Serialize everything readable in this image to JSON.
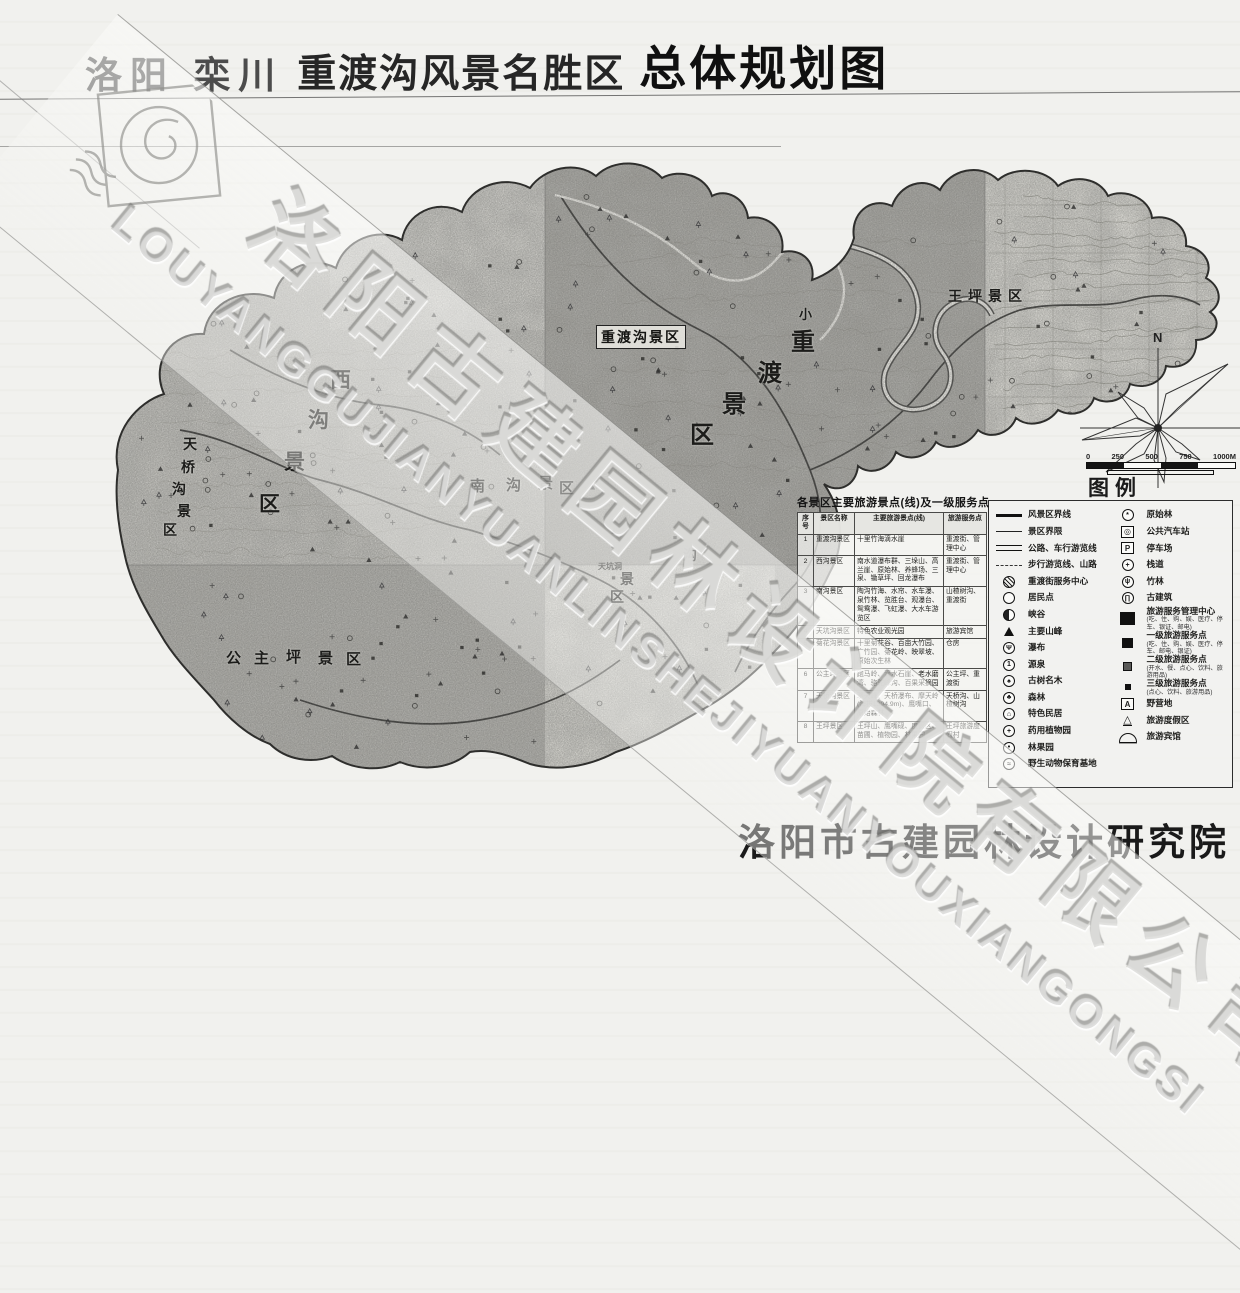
{
  "title": {
    "prefix": "洛阳 栾川",
    "name": "重渡沟风景名胜区",
    "suffix": "总体规划图"
  },
  "watermark": {
    "chinese": "洛阳古建园林设计院有限公司",
    "latin": "LOUYANGGUJIANYUANLINSHEJIYUANYOUXIANGONGSI"
  },
  "footer": {
    "publisher": "洛阳市古建园林设计研究院"
  },
  "compass": {
    "north_label": "N"
  },
  "scale_bar": {
    "ticks": [
      "0",
      "250",
      "500",
      "750",
      "1000M"
    ]
  },
  "legend": {
    "title": "图例",
    "left": [
      {
        "icon": "line-thick",
        "label": "风景区界线"
      },
      {
        "icon": "line-thin",
        "label": "景区界限"
      },
      {
        "icon": "line-double",
        "label": "公路、车行游览线"
      },
      {
        "icon": "line-dashed",
        "label": "步行游览线、山路"
      },
      {
        "icon": "circle-hatched",
        "label": "重渡街服务中心"
      },
      {
        "icon": "circle-open",
        "label": "居民点"
      },
      {
        "icon": "circle-half",
        "label": "峡谷"
      },
      {
        "icon": "triangle",
        "label": "主要山峰"
      },
      {
        "icon": "circle-waterfall",
        "label": "瀑布"
      },
      {
        "icon": "circle-one",
        "label": "源泉"
      },
      {
        "icon": "circle-tree",
        "label": "古树名木"
      },
      {
        "icon": "circle-forest",
        "label": "森林"
      },
      {
        "icon": "circle-house",
        "label": "特色民居"
      },
      {
        "icon": "circle-herb",
        "label": "药用植物园"
      },
      {
        "icon": "circle-fruit",
        "label": "林果园"
      },
      {
        "icon": "circle-animal",
        "label": "野生动物保育基地"
      }
    ],
    "right": [
      {
        "icon": "circle-pforest",
        "label": "原始林"
      },
      {
        "icon": "square-bus",
        "label": "公共汽车站"
      },
      {
        "icon": "square-p",
        "label": "停车场"
      },
      {
        "icon": "circle-cross",
        "label": "栈道"
      },
      {
        "icon": "circle-bamboo",
        "label": "竹林"
      },
      {
        "icon": "circle-temple",
        "label": "古建筑"
      },
      {
        "icon": "sq-xl",
        "label": "旅游服务管理中心",
        "note": "(吃、住、购、娱、医疗、停车、银证、邮电)"
      },
      {
        "icon": "sq-l",
        "label": "一级旅游服务点",
        "note": "(吃、住、购、娱、医疗、停车、邮电、银证)"
      },
      {
        "icon": "sq-m",
        "label": "二级旅游服务点",
        "note": "(开水、餐、点心、饮料、旅游用品)"
      },
      {
        "icon": "sq-s",
        "label": "三级旅游服务点",
        "note": "(点心、饮料、旅游用品)"
      },
      {
        "icon": "square-a",
        "label": "野营地"
      },
      {
        "icon": "tent",
        "label": "旅游度假区"
      },
      {
        "icon": "dome",
        "label": "旅游宾馆"
      }
    ]
  },
  "table": {
    "title": "各景区主要旅游景点(线)及一级服务点",
    "headers": [
      "序号",
      "景区名称",
      "主要旅游景点(线)",
      "旅游服务点"
    ],
    "rows": [
      [
        "1",
        "重渡沟景区",
        "十里竹海滴水崖",
        "重渡街、管理中心"
      ],
      [
        "2",
        "西沟景区",
        "南水道瀑布群、三垛山、高兰崖、原始林、养蜂场、三泉、锄草坪、回龙瀑布",
        "重渡街、管理中心"
      ],
      [
        "3",
        "南沟景区",
        "陶沟竹海、水帘、水车瀑、泉竹林、览胜台、观瀑台、鸳鸯瀑、飞虹瀑、大水车游览区",
        "山楂树沟、重渡街"
      ],
      [
        "4",
        "天坑沟景区",
        "特色农业观光园",
        "旅游宾馆"
      ],
      [
        "5",
        "菊花沟景区",
        "十里菊花谷、百亩大竹园、广竹园、菊花岭、映翠坡、原始次生林",
        "仓房"
      ],
      [
        "6",
        "公主坪景区",
        "跑马岭、滴水石崖、老水磨湾、骆驼峰沟、百果采摘园",
        "公主坪、重渡街"
      ],
      [
        "7",
        "天桥沟景区",
        "擎天峰、天桥瀑布、摩天岭(海拔1394.9m)、鹰嘴口、原始森林",
        "天桥沟、山楂树沟"
      ],
      [
        "8",
        "王坪景区",
        "王坪山、鹰嘴砚、度假区、苗圃、植物园、林果园",
        "王坪旅游度假村"
      ]
    ]
  },
  "map": {
    "zone_labels": [
      {
        "id": "t_box",
        "text": "重渡沟景区"
      },
      {
        "id": "big",
        "text": "重渡景区"
      },
      {
        "id": "xiao",
        "text": "小"
      },
      {
        "id": "west",
        "text": "西沟景区"
      },
      {
        "id": "nangou",
        "text": "南沟景区"
      },
      {
        "id": "tianqiao",
        "text": "天桥沟景区"
      },
      {
        "id": "gzp",
        "text": "公主坪景区"
      },
      {
        "id": "wp",
        "text": "王坪景区"
      },
      {
        "id": "tk",
        "text": "沟景区"
      },
      {
        "id": "tkd",
        "text": "天坑洞"
      }
    ]
  },
  "colors": {
    "paper": "#f0f0ed",
    "map_dark_block": "#a7a6a1",
    "map_medium_block": "#c9c8c3",
    "map_light_block": "#e2e1db",
    "boundary": "#2e2e2c",
    "title_text": "#101010"
  }
}
